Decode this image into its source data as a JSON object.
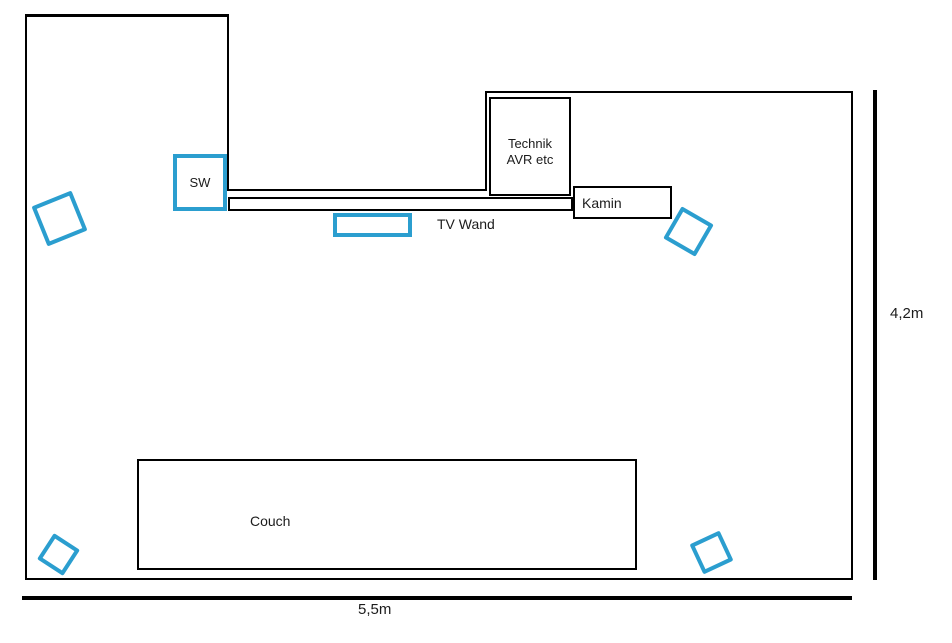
{
  "colors": {
    "speaker_blue": "#2b9ecf",
    "line_black": "#000000"
  },
  "labels": {
    "subwoofer": "SW",
    "technik_line1": "Technik",
    "technik_line2": "AVR etc",
    "kamin": "Kamin",
    "tv_wand": "TV Wand",
    "couch": "Couch",
    "dim_height": "4,2m",
    "dim_width": "5,5m"
  }
}
